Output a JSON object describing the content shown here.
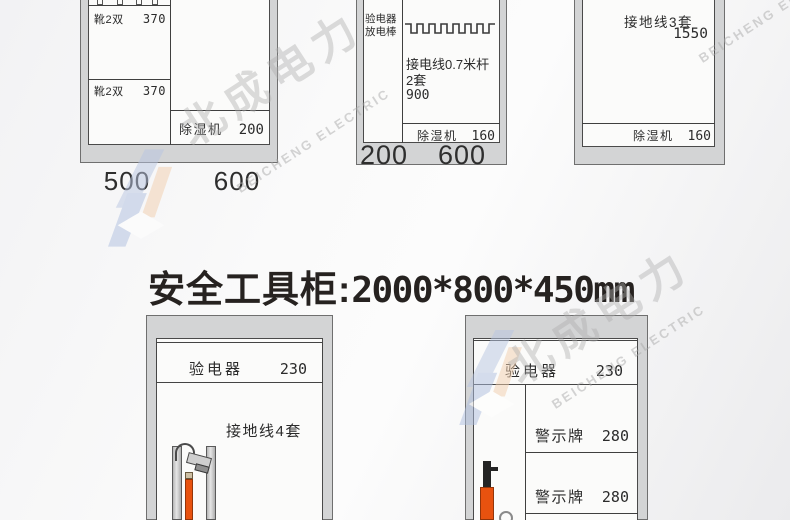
{
  "title": {
    "label": "安全工具柜:",
    "dims": "2000*800*450mm"
  },
  "watermark": {
    "cjk": "北成电力",
    "latin": "BEICHENG ELECTRIC"
  },
  "cabinets": {
    "top_left": {
      "shelves": [
        {
          "label": "靴2双",
          "value": "370"
        },
        {
          "label": "靴2双",
          "value": "370"
        }
      ],
      "dehumidifier": {
        "label": "除湿机",
        "value": "200"
      },
      "widths": [
        "500",
        "600"
      ]
    },
    "top_middle": {
      "side": [
        "验电器",
        "放电棒"
      ],
      "content": [
        "接电线0.7米杆",
        "2套",
        "900"
      ],
      "dehumidifier": {
        "label": "除湿机",
        "value": "160"
      },
      "widths": [
        "200",
        "600"
      ]
    },
    "top_right": {
      "content": {
        "label": "接地线3套",
        "value": "1550"
      },
      "dehumidifier": {
        "label": "除湿机",
        "value": "160"
      }
    },
    "bottom_left": {
      "tester": {
        "label": "验电器",
        "value": "230"
      },
      "content": "接地线4套"
    },
    "bottom_right": {
      "tester": {
        "label": "验电器",
        "value": "230"
      },
      "rows": [
        {
          "label": "警示牌",
          "value": "280"
        },
        {
          "label": "警示牌",
          "value": "280"
        }
      ]
    }
  },
  "icons": {
    "cabinet_a_hooks": "hanger-hooks",
    "cabinet_b_rail": "hook-rail",
    "cabinet_d_device": "grounding-clamp-rod",
    "cabinet_e_device": "discharge-rod"
  },
  "colors": {
    "frame": "#d3d4d5",
    "frame_border": "#6f6f6f",
    "panel": "#fbfbfa",
    "line": "#3f3f3f",
    "text": "#2b2b2b",
    "accent_orange": "#e8520f",
    "wm_blue": "#b9c6e2",
    "wm_orange": "#f3cfad",
    "wm_text": "#aeaeae"
  }
}
